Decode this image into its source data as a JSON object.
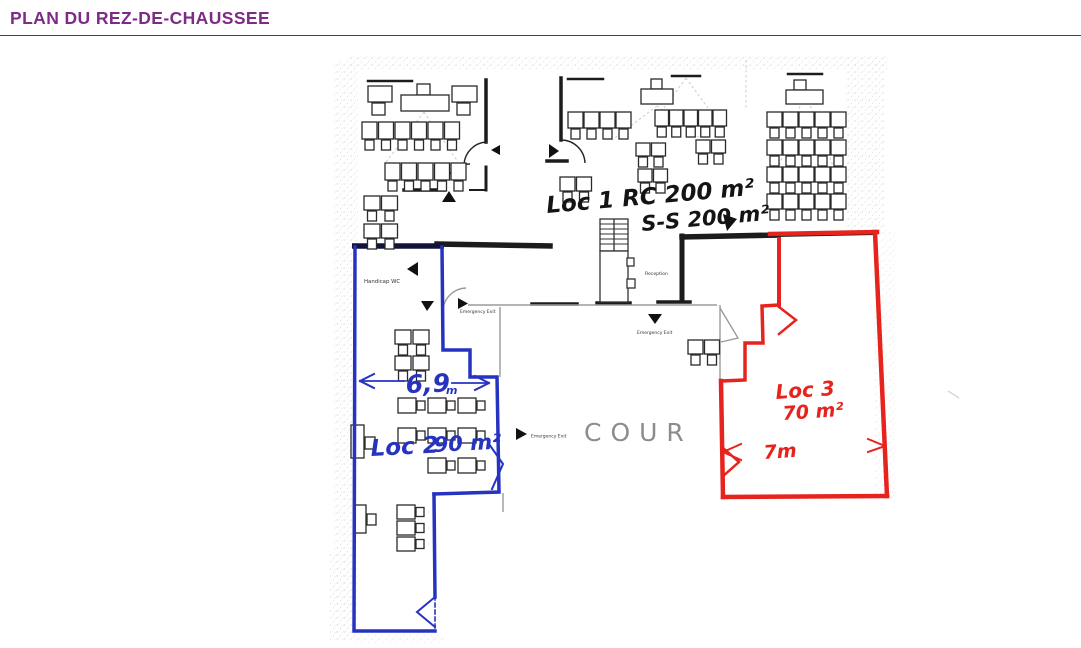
{
  "page": {
    "title": "PLAN DU REZ-DE-CHAUSSEE",
    "title_color": "#7d2b86"
  },
  "plan": {
    "annotations": {
      "loc1_line1": "Loc 1 RC 200 m²",
      "loc1_line2": "S-S 200 m²",
      "loc2_label": "Loc 2",
      "loc2_area": "90 m²",
      "loc2_width_value": "6,9",
      "loc2_width_unit": "m",
      "loc3_label": "Loc 3",
      "loc3_area": "70 m²",
      "loc3_width": "7m",
      "courtyard": "COUR"
    },
    "labels": {
      "handicap_wc": "Handicap WC",
      "emergency_exit": "Emergency Exit",
      "reception": "Reception"
    },
    "colors": {
      "loc2_outline": "#2633c0",
      "loc3_outline": "#e6231d",
      "walls": "#1c1c1c",
      "pencil": "#8c8c8c"
    }
  }
}
